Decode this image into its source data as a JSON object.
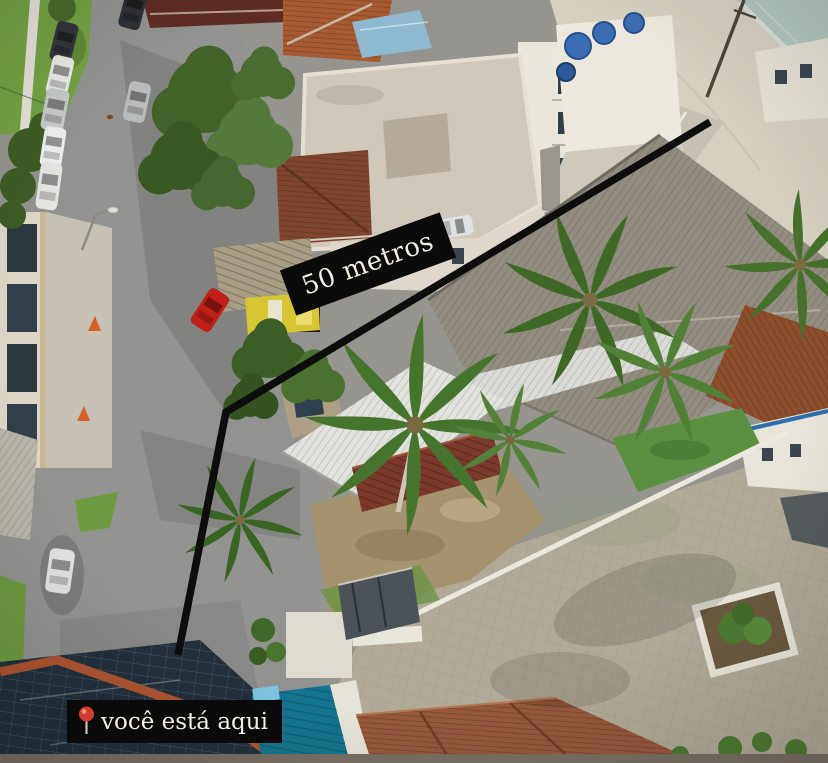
{
  "annotations": {
    "distance_label": "50 metros",
    "you_are_here_label": "você está aqui",
    "pin_icon": "location-pin-icon",
    "colors": {
      "overlay_background": "#0a0a0a",
      "overlay_text": "#f2eee4",
      "pin_red": "#d63a2c",
      "pin_stem": "#c9bfae",
      "path_line": "#0d0d0d"
    }
  }
}
